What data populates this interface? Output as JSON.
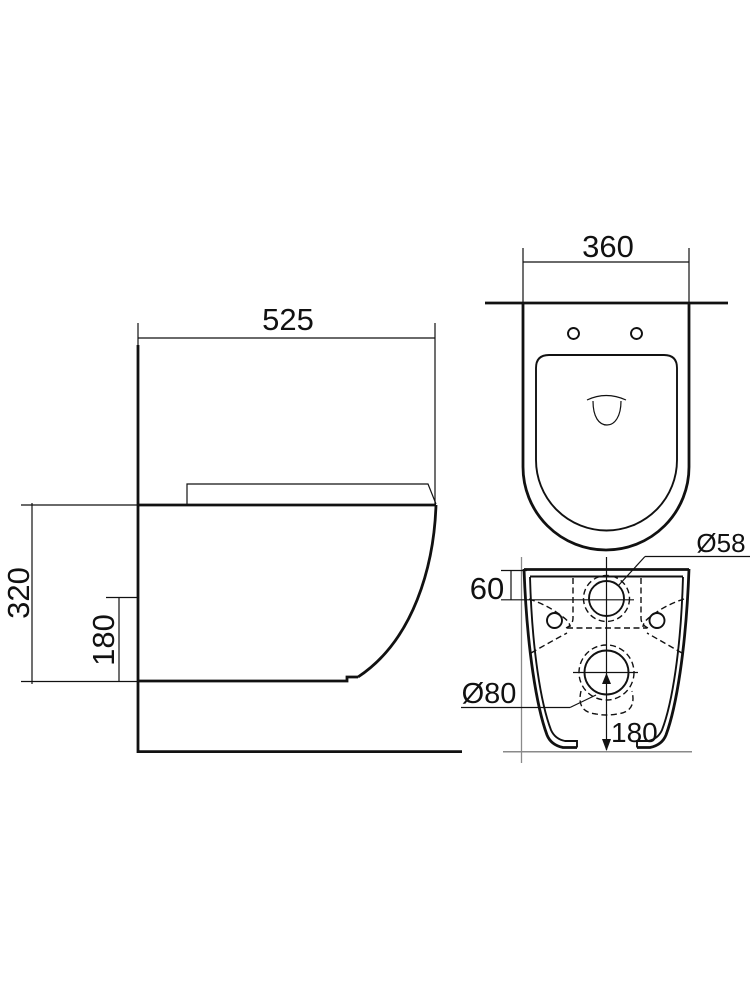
{
  "drawing": {
    "labels": {
      "side_depth": "525",
      "side_height": "320",
      "side_lower_height": "180",
      "top_width": "360",
      "inlet_top_offset": "60",
      "inlet_diameter": "Ø58",
      "outlet_diameter": "Ø80",
      "outlet_bottom_distance": "180"
    },
    "colors": {
      "line": "#111111",
      "reference_line": "#8a8a8a",
      "background": "#ffffff"
    }
  }
}
